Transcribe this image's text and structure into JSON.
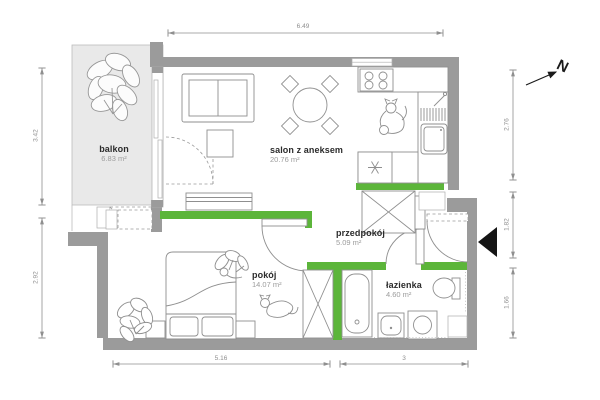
{
  "compass": {
    "label": "N"
  },
  "rooms": [
    {
      "name": "balkon",
      "area": "6.83 m²"
    },
    {
      "name": "salon z aneksem",
      "area": "20.76 m²"
    },
    {
      "name": "przedpokój",
      "area": "5.09 m²"
    },
    {
      "name": "pokój",
      "area": "14.07 m²"
    },
    {
      "name": "łazienka",
      "area": "4.60 m²"
    }
  ],
  "dimensions": {
    "top": [
      {
        "label": "6.49"
      }
    ],
    "left": [
      {
        "label": "3.42"
      },
      {
        "label": "2.92"
      }
    ],
    "right": [
      {
        "label": "2.76"
      },
      {
        "label": "1.82"
      },
      {
        "label": "1.66"
      }
    ],
    "bottom": [
      {
        "label": "5.16"
      },
      {
        "label": "3"
      }
    ]
  },
  "colors": {
    "wall": "#9b9b9b",
    "accent_green": "#5cb53a",
    "balcony_fill": "#e9e9e9",
    "dimension": "#8f8f8f",
    "room_name": "#2b2b2b",
    "room_area": "#9c9c9c",
    "furniture_stroke": "#8f8f8f",
    "entrance_marker": "#151515"
  }
}
